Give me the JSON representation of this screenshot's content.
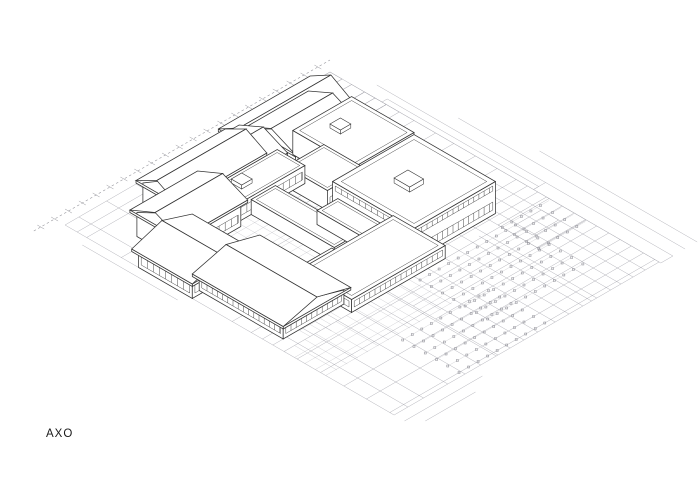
{
  "label": {
    "text": "AXO"
  },
  "colors": {
    "background": "#ffffff",
    "building_line": "#333333",
    "building_fill": "#ffffff",
    "site_line": "#b3b3ba",
    "paving_line": "#c7c7cc",
    "detail_line": "#ababb2",
    "road_line": "#b3b3ba",
    "boundary_line": "#95959c",
    "marker": "#8d8d95",
    "row_line": "#cacace",
    "label_color": "#1a1a1a"
  },
  "iso": {
    "origin": [
      65,
      225
    ],
    "cos": 0.866,
    "sin": 0.5
  },
  "site": {
    "extent": {
      "u": [
        0,
        306
      ],
      "v": [
        0,
        380
      ]
    },
    "lines_const_u": [
      [
        0,
        0,
        380
      ],
      [
        16,
        0,
        380
      ],
      [
        34,
        150,
        380
      ],
      [
        48,
        0,
        260
      ],
      [
        62,
        150,
        380
      ],
      [
        82,
        0,
        380
      ],
      [
        100,
        193,
        380
      ],
      [
        118,
        97,
        380
      ],
      [
        120,
        240,
        380
      ],
      [
        134,
        0,
        380
      ],
      [
        150,
        193,
        380
      ],
      [
        166,
        0,
        380
      ],
      [
        186,
        60,
        380
      ],
      [
        202,
        0,
        380
      ],
      [
        218,
        143,
        380
      ],
      [
        228,
        250,
        380
      ],
      [
        234,
        0,
        380
      ],
      [
        250,
        0,
        380
      ],
      [
        262,
        143,
        380
      ],
      [
        276,
        0,
        380
      ],
      [
        290,
        60,
        380
      ],
      [
        306,
        0,
        380
      ]
    ],
    "lines_const_v": [
      [
        0,
        0,
        306
      ],
      [
        14,
        0,
        306
      ],
      [
        25,
        0,
        306
      ],
      [
        40,
        258,
        306
      ],
      [
        65,
        0,
        306
      ],
      [
        97,
        0,
        306
      ],
      [
        122,
        260,
        306
      ],
      [
        143,
        0,
        306
      ],
      [
        168,
        260,
        306
      ],
      [
        193,
        0,
        306
      ],
      [
        215,
        0,
        306
      ],
      [
        228,
        0,
        306
      ],
      [
        240,
        0,
        306
      ],
      [
        253,
        0,
        306
      ],
      [
        268,
        0,
        306
      ],
      [
        282,
        120,
        306
      ],
      [
        295,
        0,
        306
      ],
      [
        308,
        120,
        306
      ],
      [
        322,
        0,
        306
      ],
      [
        335,
        120,
        306
      ],
      [
        348,
        0,
        306
      ],
      [
        362,
        120,
        306
      ],
      [
        375,
        0,
        306
      ],
      [
        380,
        0,
        306
      ]
    ],
    "detail_rects": [
      [
        246,
        0,
        258,
        25
      ],
      [
        258,
        25,
        306,
        40
      ],
      [
        262,
        0,
        280,
        14
      ],
      [
        270,
        40,
        306,
        65
      ],
      [
        270,
        14,
        290,
        25
      ],
      [
        280,
        65,
        306,
        80
      ],
      [
        286,
        52,
        306,
        65
      ],
      [
        290,
        0,
        306,
        14
      ],
      [
        294,
        40,
        306,
        52
      ],
      [
        276,
        25,
        290,
        40
      ],
      [
        250,
        250,
        306,
        296
      ],
      [
        260,
        260,
        290,
        280
      ]
    ],
    "paving": [
      {
        "u": [
          82,
          166
        ],
        "v": [
          97,
          193
        ],
        "step": 10
      },
      {
        "u": [
          0,
          146
        ],
        "v": [
          253,
          302
        ],
        "step": 12
      },
      {
        "u": [
          30,
          80
        ],
        "v": [
          193,
          253
        ],
        "step": 12
      },
      {
        "u": [
          146,
          166
        ],
        "v": [
          97,
          145
        ],
        "step": 10
      }
    ],
    "strips": [
      [
        306,
        235,
        320,
        382
      ],
      [
        306,
        60,
        312,
        235
      ]
    ],
    "outside_lines_const_u": [
      [
        320,
        40,
        235
      ],
      [
        334,
        120,
        382
      ],
      [
        348,
        200,
        382
      ],
      [
        -10,
        30,
        140
      ]
    ],
    "outside_lines_const_v": [
      [
        392,
        0,
        90
      ],
      [
        404,
        12,
        70
      ]
    ],
    "boundary": {
      "v_offset": -12,
      "u_from": -24,
      "u_to": 318,
      "tick_step": 16
    }
  },
  "parking": {
    "banks": [
      {
        "u": [
          150,
          260
        ],
        "ustep": 11,
        "v": [
          260,
          340
        ],
        "vstep": 13
      },
      {
        "u": [
          80,
          180
        ],
        "ustep": 11,
        "v": [
          310,
          378
        ],
        "vstep": 13
      },
      {
        "u": [
          250,
          304
        ],
        "ustep": 11,
        "v": [
          255,
          299
        ],
        "vstep": 14
      }
    ]
  },
  "building": {
    "blocks": [
      {
        "id": "nw-bar-2",
        "u": [
          160,
          258
        ],
        "v": [
          25,
          65
        ],
        "h": 26,
        "roof": "gu",
        "rh": 13,
        "win": [
          {
            "face": "v1",
            "zb": 17,
            "zt": 22,
            "step": 8
          }
        ]
      },
      {
        "id": "n-pavilion-2",
        "u": [
          175,
          238
        ],
        "v": [
          43,
          91
        ],
        "h": 30,
        "roof": "gu",
        "rh": 12,
        "win": [
          {
            "face": "v1",
            "zb": 22,
            "zt": 27,
            "step": 8
          }
        ]
      },
      {
        "id": "ne-flat-1",
        "u": [
          202,
          270
        ],
        "v": [
          61,
          133
        ],
        "h": 24,
        "roof": "flat",
        "inset": 4,
        "win": [
          {
            "face": "v1",
            "zb": 5,
            "zt": 14,
            "step": 7
          }
        ],
        "units": [
          [
            226,
            80,
            238,
            92,
            4
          ]
        ]
      },
      {
        "id": "nw-bar-1",
        "u": [
          65,
          160
        ],
        "v": [
          25,
          65
        ],
        "h": 22,
        "roof": "gu",
        "rh": 12,
        "win": [
          {
            "face": "v1",
            "zb": 14,
            "zt": 19,
            "step": 8
          }
        ]
      },
      {
        "id": "ne-flat-2",
        "u": [
          166,
          210
        ],
        "v": [
          89,
          137
        ],
        "h": 20,
        "roof": "flat",
        "inset": 3,
        "win": [
          {
            "face": "v1",
            "zb": 4,
            "zt": 12,
            "step": 7
          }
        ]
      },
      {
        "id": "n-pavilion-1",
        "u": [
          100,
          166
        ],
        "v": [
          35,
          83
        ],
        "h": 28,
        "roof": "gu",
        "rh": 12,
        "win": [
          {
            "face": "v1",
            "zb": 20,
            "zt": 25,
            "step": 8
          }
        ]
      },
      {
        "id": "mid-bar",
        "u": [
          82,
          180
        ],
        "v": [
          65,
          97
        ],
        "h": 18,
        "roof": "flat",
        "inset": 3,
        "win": [
          {
            "face": "v1",
            "zb": 5,
            "zt": 13,
            "step": 7
          }
        ],
        "units": [
          [
            120,
            72,
            132,
            84,
            4
          ]
        ]
      },
      {
        "id": "east-hall",
        "u": [
          166,
          260
        ],
        "v": [
          143,
          237
        ],
        "h": 32,
        "roof": "flat",
        "inset": 5,
        "win": [
          {
            "face": "v1",
            "zb": 5,
            "zt": 13,
            "step": 6
          },
          {
            "face": "v1",
            "zb": 24,
            "zt": 29,
            "step": 6
          },
          {
            "face": "u0",
            "zb": 24,
            "zt": 29,
            "step": 7
          }
        ],
        "units": [
          [
            200,
            180,
            216,
            198,
            5
          ]
        ]
      },
      {
        "id": "nw-gable-3",
        "u": [
          30,
          100
        ],
        "v": [
          53,
          103
        ],
        "h": 24,
        "roof": "gu",
        "rh": 12,
        "win": [
          {
            "face": "v1",
            "zb": 5,
            "zt": 13,
            "step": 7
          }
        ]
      },
      {
        "id": "east-low-link",
        "u": [
          146,
          170
        ],
        "v": [
          145,
          225
        ],
        "h": 14,
        "roof": "flat",
        "inset": 3,
        "win": [
          {
            "face": "v1",
            "zb": 3,
            "zt": 10,
            "step": 6
          }
        ]
      },
      {
        "id": "court-link",
        "u": [
          118,
          146
        ],
        "v": [
          97,
          193
        ],
        "h": 15,
        "roof": "flat",
        "inset": 3,
        "win": [
          {
            "face": "v1",
            "zb": 4,
            "zt": 11,
            "step": 6
          }
        ]
      },
      {
        "id": "court-slab-1",
        "u": [
          96,
          128
        ],
        "v": [
          180,
          188
        ],
        "h": 3,
        "roof": "flat"
      },
      {
        "id": "court-slab-2",
        "u": [
          120,
          152
        ],
        "v": [
          118,
          126
        ],
        "h": 3,
        "roof": "flat"
      },
      {
        "id": "west-house",
        "u": [
          0,
          62
        ],
        "v": [
          85,
          147
        ],
        "h": 16,
        "roof": "gv",
        "rh": 11,
        "win": [
          {
            "face": "u0",
            "zb": 4,
            "zt": 12,
            "step": 7
          },
          {
            "face": "v1",
            "zb": 4,
            "zt": 12,
            "step": 7
          }
        ]
      },
      {
        "id": "south-range",
        "u": [
          78,
          186
        ],
        "v": [
          193,
          253
        ],
        "h": 13,
        "roof": "flat",
        "inset": 4,
        "win": [
          {
            "face": "v1",
            "zb": 4,
            "zt": 10,
            "step": 6
          },
          {
            "face": "u0",
            "zb": 4,
            "zt": 10,
            "step": 6
          }
        ]
      },
      {
        "id": "sw-wing",
        "u": [
          12,
          82
        ],
        "v": [
          143,
          240
        ],
        "h": 14,
        "roof": "gv",
        "rh": 10,
        "win": [
          {
            "face": "u0",
            "zb": 4,
            "zt": 11,
            "step": 6
          },
          {
            "face": "v1",
            "zb": 4,
            "zt": 11,
            "step": 6
          }
        ]
      }
    ]
  }
}
